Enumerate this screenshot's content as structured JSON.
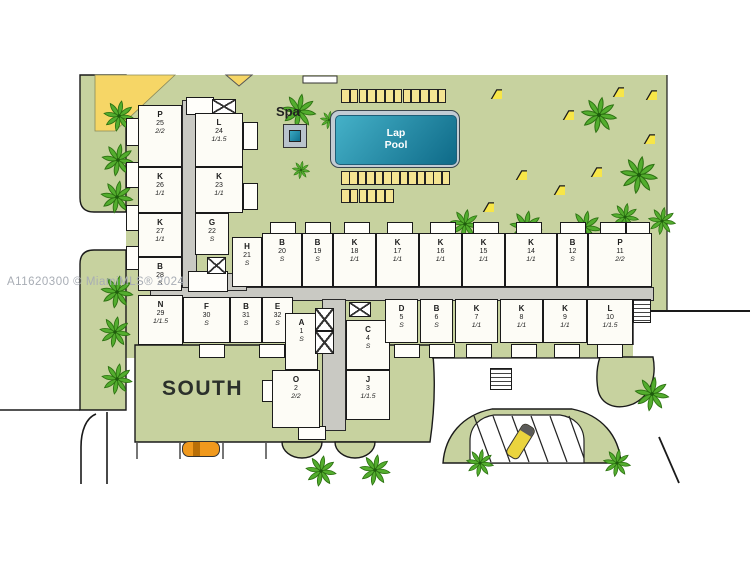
{
  "watermark": "A11620300 © MiamiMLS® 2024",
  "labels": {
    "south": "SOUTH",
    "spa": "Spa",
    "pool": "Lap Pool"
  },
  "colors": {
    "lawn": "#c7d29f",
    "yellow_patch": "#f6d666",
    "umbrella": "#f7e648",
    "pool_light": "#45b1c8",
    "pool_dark": "#0e6a88",
    "building": "#fdfcf6",
    "corridor": "#c9c9c3",
    "car_orange": "#f0991d",
    "car_yellow": "#ead43e",
    "palm": "#53ad2e",
    "outline": "#1a1a1a"
  },
  "units": [
    {
      "letter": "P",
      "number": "25",
      "config": "2/2"
    },
    {
      "letter": "L",
      "number": "24",
      "config": "1/1.5"
    },
    {
      "letter": "K",
      "number": "26",
      "config": "1/1"
    },
    {
      "letter": "K",
      "number": "23",
      "config": "1/1"
    },
    {
      "letter": "K",
      "number": "27",
      "config": "1/1"
    },
    {
      "letter": "G",
      "number": "22",
      "config": "S"
    },
    {
      "letter": "B",
      "number": "28",
      "config": "S"
    },
    {
      "letter": "H",
      "number": "21",
      "config": "S"
    },
    {
      "letter": "B",
      "number": "20",
      "config": "S"
    },
    {
      "letter": "B",
      "number": "19",
      "config": "S"
    },
    {
      "letter": "K",
      "number": "18",
      "config": "1/1"
    },
    {
      "letter": "K",
      "number": "17",
      "config": "1/1"
    },
    {
      "letter": "K",
      "number": "16",
      "config": "1/1"
    },
    {
      "letter": "K",
      "number": "15",
      "config": "1/1"
    },
    {
      "letter": "K",
      "number": "14",
      "config": "1/1"
    },
    {
      "letter": "B",
      "number": "12",
      "config": "S"
    },
    {
      "letter": "P",
      "number": "11",
      "config": "2/2"
    },
    {
      "letter": "N",
      "number": "29",
      "config": "1/1.5"
    },
    {
      "letter": "F",
      "number": "30",
      "config": "S"
    },
    {
      "letter": "B",
      "number": "31",
      "config": "S"
    },
    {
      "letter": "E",
      "number": "32",
      "config": "S"
    },
    {
      "letter": "A",
      "number": "1",
      "config": "S"
    },
    {
      "letter": "C",
      "number": "4",
      "config": "S"
    },
    {
      "letter": "O",
      "number": "2",
      "config": "2/2"
    },
    {
      "letter": "J",
      "number": "3",
      "config": "1/1.5"
    },
    {
      "letter": "D",
      "number": "5",
      "config": "S"
    },
    {
      "letter": "B",
      "number": "6",
      "config": "S"
    },
    {
      "letter": "K",
      "number": "7",
      "config": "1/1"
    },
    {
      "letter": "K",
      "number": "8",
      "config": "1/1"
    },
    {
      "letter": "K",
      "number": "9",
      "config": "1/1"
    },
    {
      "letter": "L",
      "number": "10",
      "config": "1/1.5"
    }
  ],
  "decorations": {
    "palms": [
      {
        "x": 100,
        "y": 97,
        "s": 0.95
      },
      {
        "x": 98,
        "y": 140,
        "s": 1
      },
      {
        "x": 97,
        "y": 177,
        "s": 1
      },
      {
        "x": 97,
        "y": 272,
        "s": 1
      },
      {
        "x": 96,
        "y": 313,
        "s": 0.95
      },
      {
        "x": 98,
        "y": 360,
        "s": 0.95
      },
      {
        "x": 278,
        "y": 90,
        "s": 1.05
      },
      {
        "x": 318,
        "y": 109,
        "s": 0.55
      },
      {
        "x": 290,
        "y": 159,
        "s": 0.55
      },
      {
        "x": 577,
        "y": 93,
        "s": 1.1
      },
      {
        "x": 616,
        "y": 152,
        "s": 1.15
      },
      {
        "x": 447,
        "y": 206,
        "s": 0.9
      },
      {
        "x": 506,
        "y": 207,
        "s": 1
      },
      {
        "x": 565,
        "y": 207,
        "s": 1
      },
      {
        "x": 608,
        "y": 200,
        "s": 0.85
      },
      {
        "x": 645,
        "y": 204,
        "s": 0.85
      },
      {
        "x": 302,
        "y": 452,
        "s": 0.95
      },
      {
        "x": 356,
        "y": 451,
        "s": 0.95
      },
      {
        "x": 631,
        "y": 373,
        "s": 1.05
      },
      {
        "x": 463,
        "y": 446,
        "s": 0.85
      },
      {
        "x": 600,
        "y": 446,
        "s": 0.85
      }
    ],
    "umbrellas": [
      {
        "x": 490,
        "y": 87
      },
      {
        "x": 612,
        "y": 85
      },
      {
        "x": 645,
        "y": 88
      },
      {
        "x": 562,
        "y": 108
      },
      {
        "x": 643,
        "y": 132
      },
      {
        "x": 515,
        "y": 168
      },
      {
        "x": 590,
        "y": 165
      },
      {
        "x": 553,
        "y": 183
      },
      {
        "x": 482,
        "y": 200
      }
    ],
    "chair_rows": [
      {
        "x": 341,
        "y": 89,
        "count": 12,
        "gap": 8.8
      },
      {
        "x": 341,
        "y": 171,
        "count": 13,
        "gap": 8.4
      },
      {
        "x": 341,
        "y": 189,
        "count": 6,
        "gap": 8.8
      }
    ]
  }
}
